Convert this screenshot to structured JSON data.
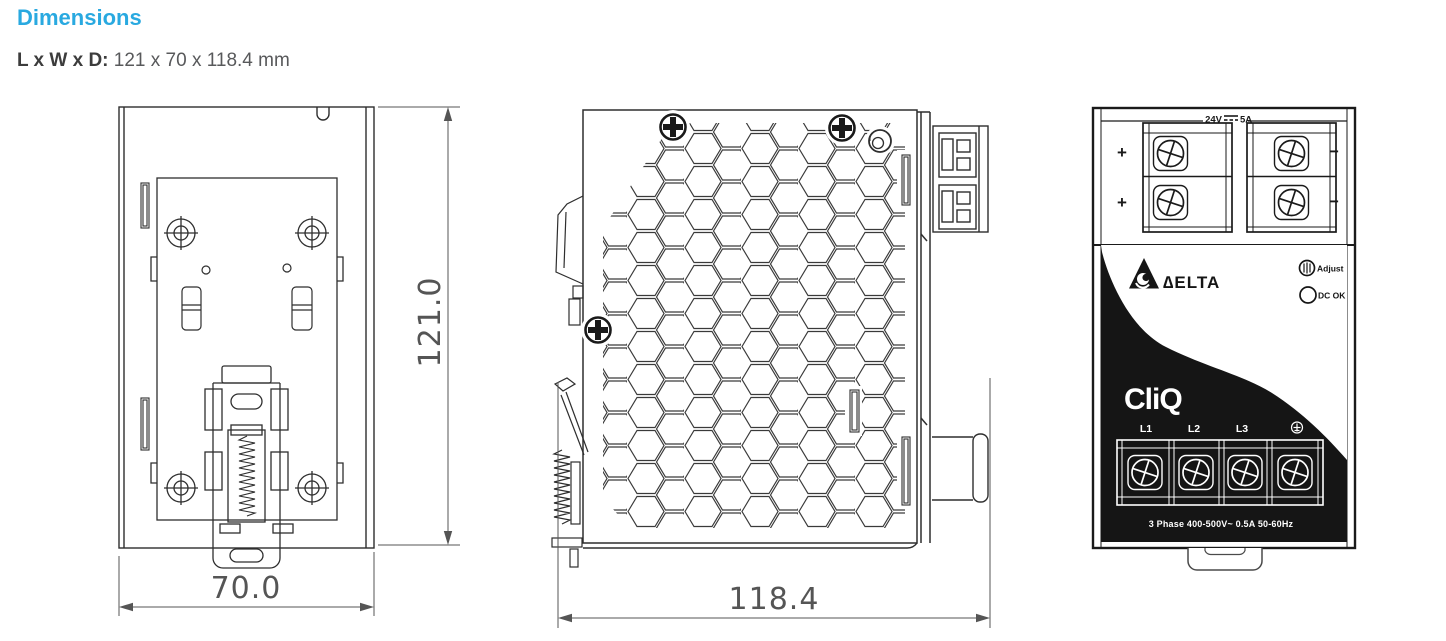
{
  "header": {
    "title": "Dimensions",
    "size_label": "L x W x D:",
    "size_value": "121 x 70 x 118.4 mm"
  },
  "dimensions": {
    "height_mm": "121.0",
    "width_mm": "70.0",
    "depth_mm": "118.4"
  },
  "front_panel": {
    "output_voltage": "24V",
    "output_current": "5A",
    "polarity_positive": "+",
    "polarity_negative": "−",
    "brand": "∆ELTA",
    "adjust_label": "Adjust",
    "dc_ok_label": "DC OK",
    "series_logo": "CliQ",
    "input_terminals": [
      "L1",
      "L2",
      "L3"
    ],
    "input_rating": "3 Phase 400-500V~ 0.5A 50-60Hz"
  },
  "colors": {
    "accent": "#29a9e0",
    "ink": "#2e2e2e",
    "dim_text": "#555555",
    "panel_black": "#151515"
  }
}
